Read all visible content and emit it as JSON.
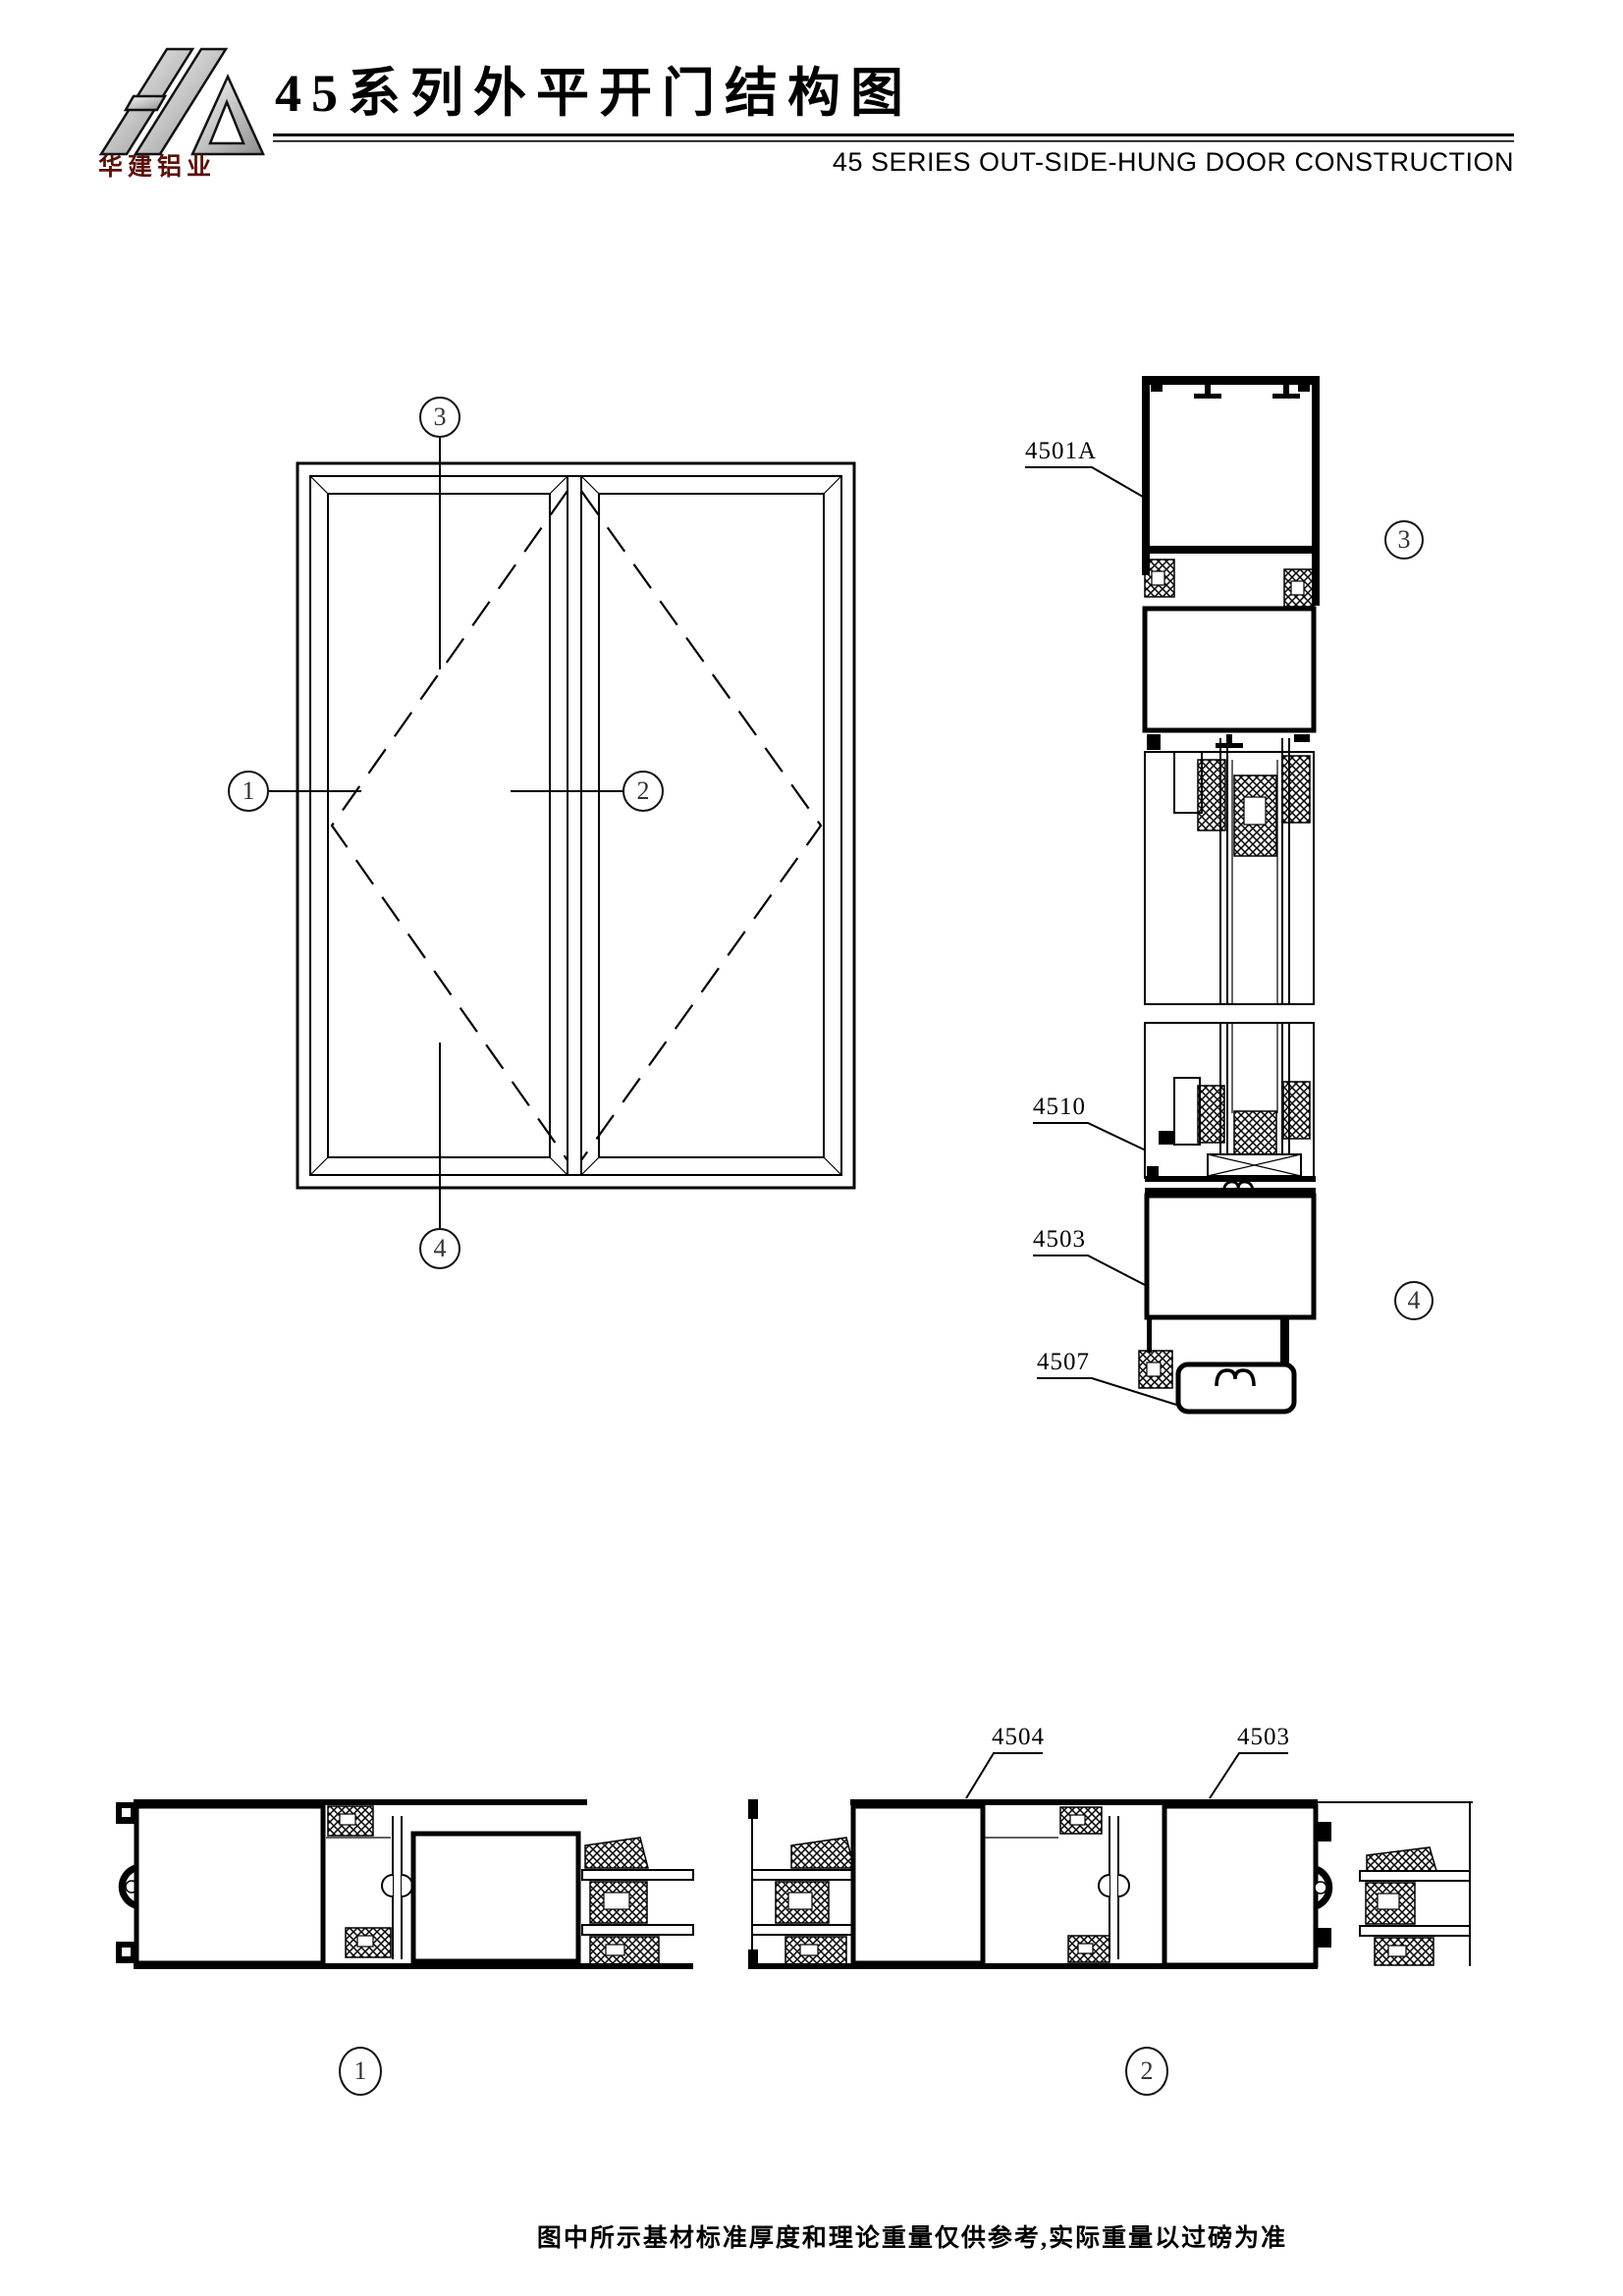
{
  "header": {
    "logo_text": "华建铝业",
    "title": "45系列外平开门结构图",
    "subtitle": "45 SERIES OUT-SIDE-HUNG DOOR CONSTRUCTION"
  },
  "callouts": {
    "c1": "1",
    "c2": "2",
    "c3": "3",
    "c4": "4"
  },
  "part_labels": {
    "head_frame": "4501A",
    "glazing_bead": "4510",
    "bottom_frame": "4503",
    "threshold": "4507",
    "meeting_stile": "4504",
    "side_frame": "4503"
  },
  "footer": {
    "note": "图中所示基材标准厚度和理论重量仅供参考,实际重量以过磅为准"
  },
  "colors": {
    "line": "#000000",
    "logo_text": "#5a1008",
    "paper": "#ffffff"
  }
}
